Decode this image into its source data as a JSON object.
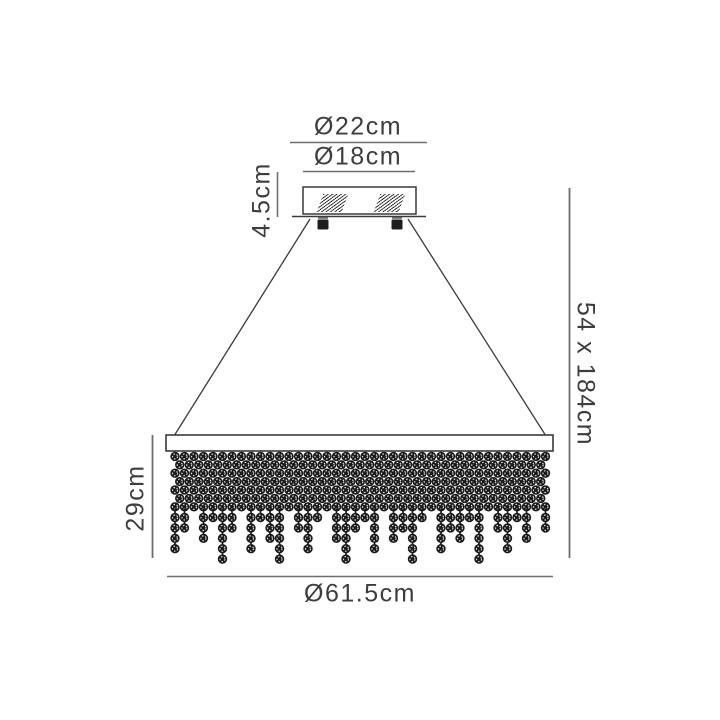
{
  "dimensions": {
    "canopy_outer_diameter": "Ø22cm",
    "canopy_inner_diameter": "Ø18cm",
    "canopy_height": "4.5cm",
    "shade_height": "29cm",
    "shade_diameter": "Ø61.5cm",
    "overall_size": "54 x 184cm"
  },
  "colors": {
    "background": "#ffffff",
    "text": "#3d3d3d",
    "drawing_line": "#3a3a3a",
    "dimension_line": "#6e6e6e",
    "bead": "#1b1b1b",
    "bead_sparkle": "#ffffff"
  },
  "beads": {
    "columns": 40,
    "dense_rows": 7,
    "strand_pattern": [
      4,
      2,
      0,
      3,
      1,
      5,
      2,
      0,
      4,
      1,
      3,
      5,
      0,
      2,
      4,
      1,
      0,
      3,
      5,
      2,
      1,
      4,
      0,
      3,
      2,
      5,
      1,
      0,
      4,
      2,
      3,
      1,
      5,
      0,
      2,
      4,
      1,
      3,
      0,
      2
    ]
  }
}
